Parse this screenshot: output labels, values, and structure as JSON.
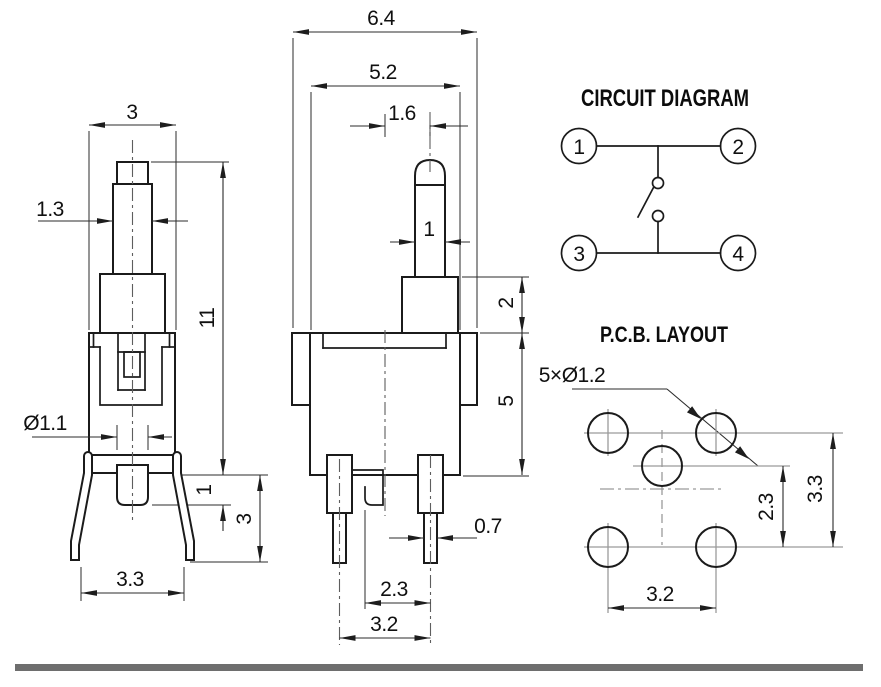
{
  "side_view": {
    "dim_top_width": "3",
    "dim_stem_width": "1.3",
    "dim_total_height": "11",
    "dim_pin_diameter": "Ø1.1",
    "dim_pin_protrusion": "1",
    "dim_leg_height": "3",
    "dim_leg_span": "3.3"
  },
  "front_view": {
    "dim_overall_width": "6.4",
    "dim_body_width": "5.2",
    "dim_actuator_offset": "1.6",
    "dim_actuator_width": "1",
    "dim_step_height": "2",
    "dim_body_height": "5",
    "dim_terminal_width": "0.7",
    "dim_terminal_offset": "2.3",
    "dim_terminal_pitch": "3.2"
  },
  "circuit_diagram": {
    "title": "CIRCUIT DIAGRAM",
    "terminals": [
      "1",
      "2",
      "3",
      "4"
    ]
  },
  "pcb_layout": {
    "title": "P.C.B. LAYOUT",
    "hole_callout": "5×Ø1.2",
    "dim_center_to_row": "2.3",
    "dim_row_spacing": "3.3",
    "dim_hole_pitch": "3.2"
  }
}
